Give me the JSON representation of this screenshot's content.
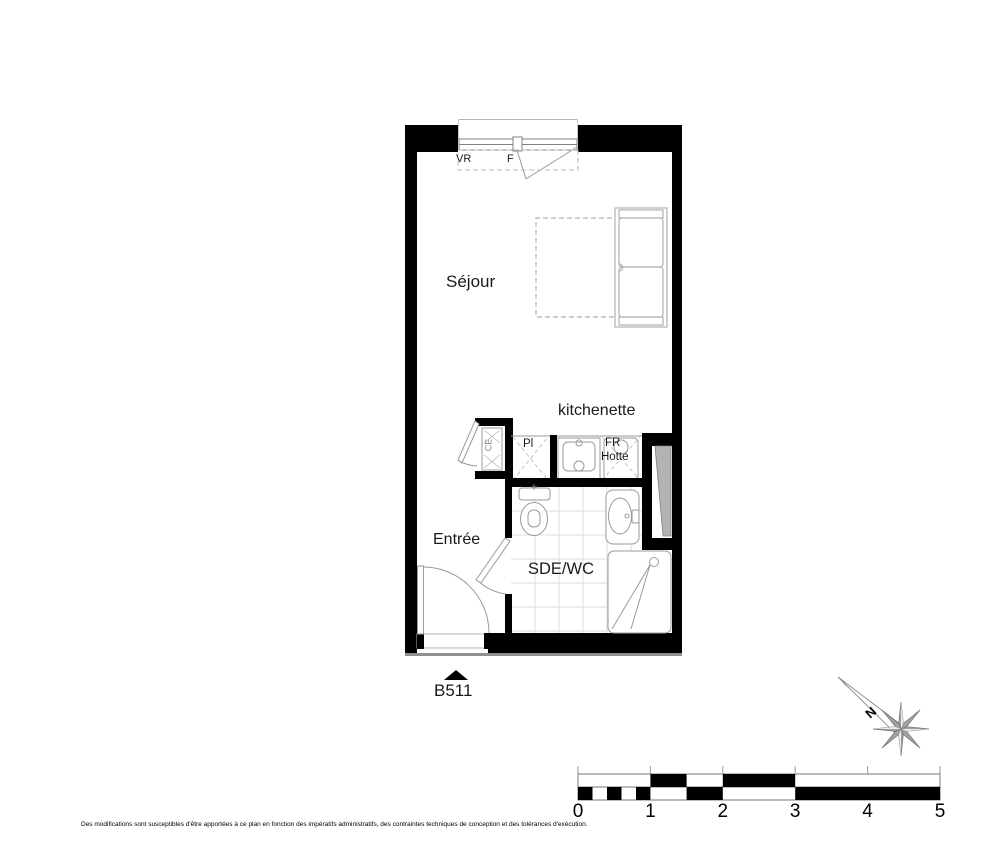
{
  "plan": {
    "unit_label": "B511",
    "rooms": {
      "sejour": {
        "label": "Séjour"
      },
      "kitchenette": {
        "label": "kitchenette"
      },
      "entree": {
        "label": "Entrée"
      },
      "sdewc": {
        "label": "SDE/WC"
      }
    },
    "annotations": {
      "vr": "VR",
      "f": "F",
      "pl": "Pl",
      "fr": "FR",
      "hotte": "Hotte",
      "ce": "CE"
    },
    "colors": {
      "wall": "#000000",
      "fixture_line": "#9a9a9a",
      "duct_fill": "#b3b3b3",
      "tile_line": "#dedede"
    }
  },
  "compass": {
    "north_label": "N"
  },
  "scale_bar": {
    "labels": [
      "0",
      "1",
      "2",
      "3",
      "4",
      "5"
    ],
    "unit": "m",
    "total_meters": 5
  },
  "footer": {
    "disclaimer": "Des modifications sont susceptibles d'être apportées à ce plan en fonction des impératifs administratifs, des contraintes techniques de conception et des tolérances d'exécution."
  }
}
